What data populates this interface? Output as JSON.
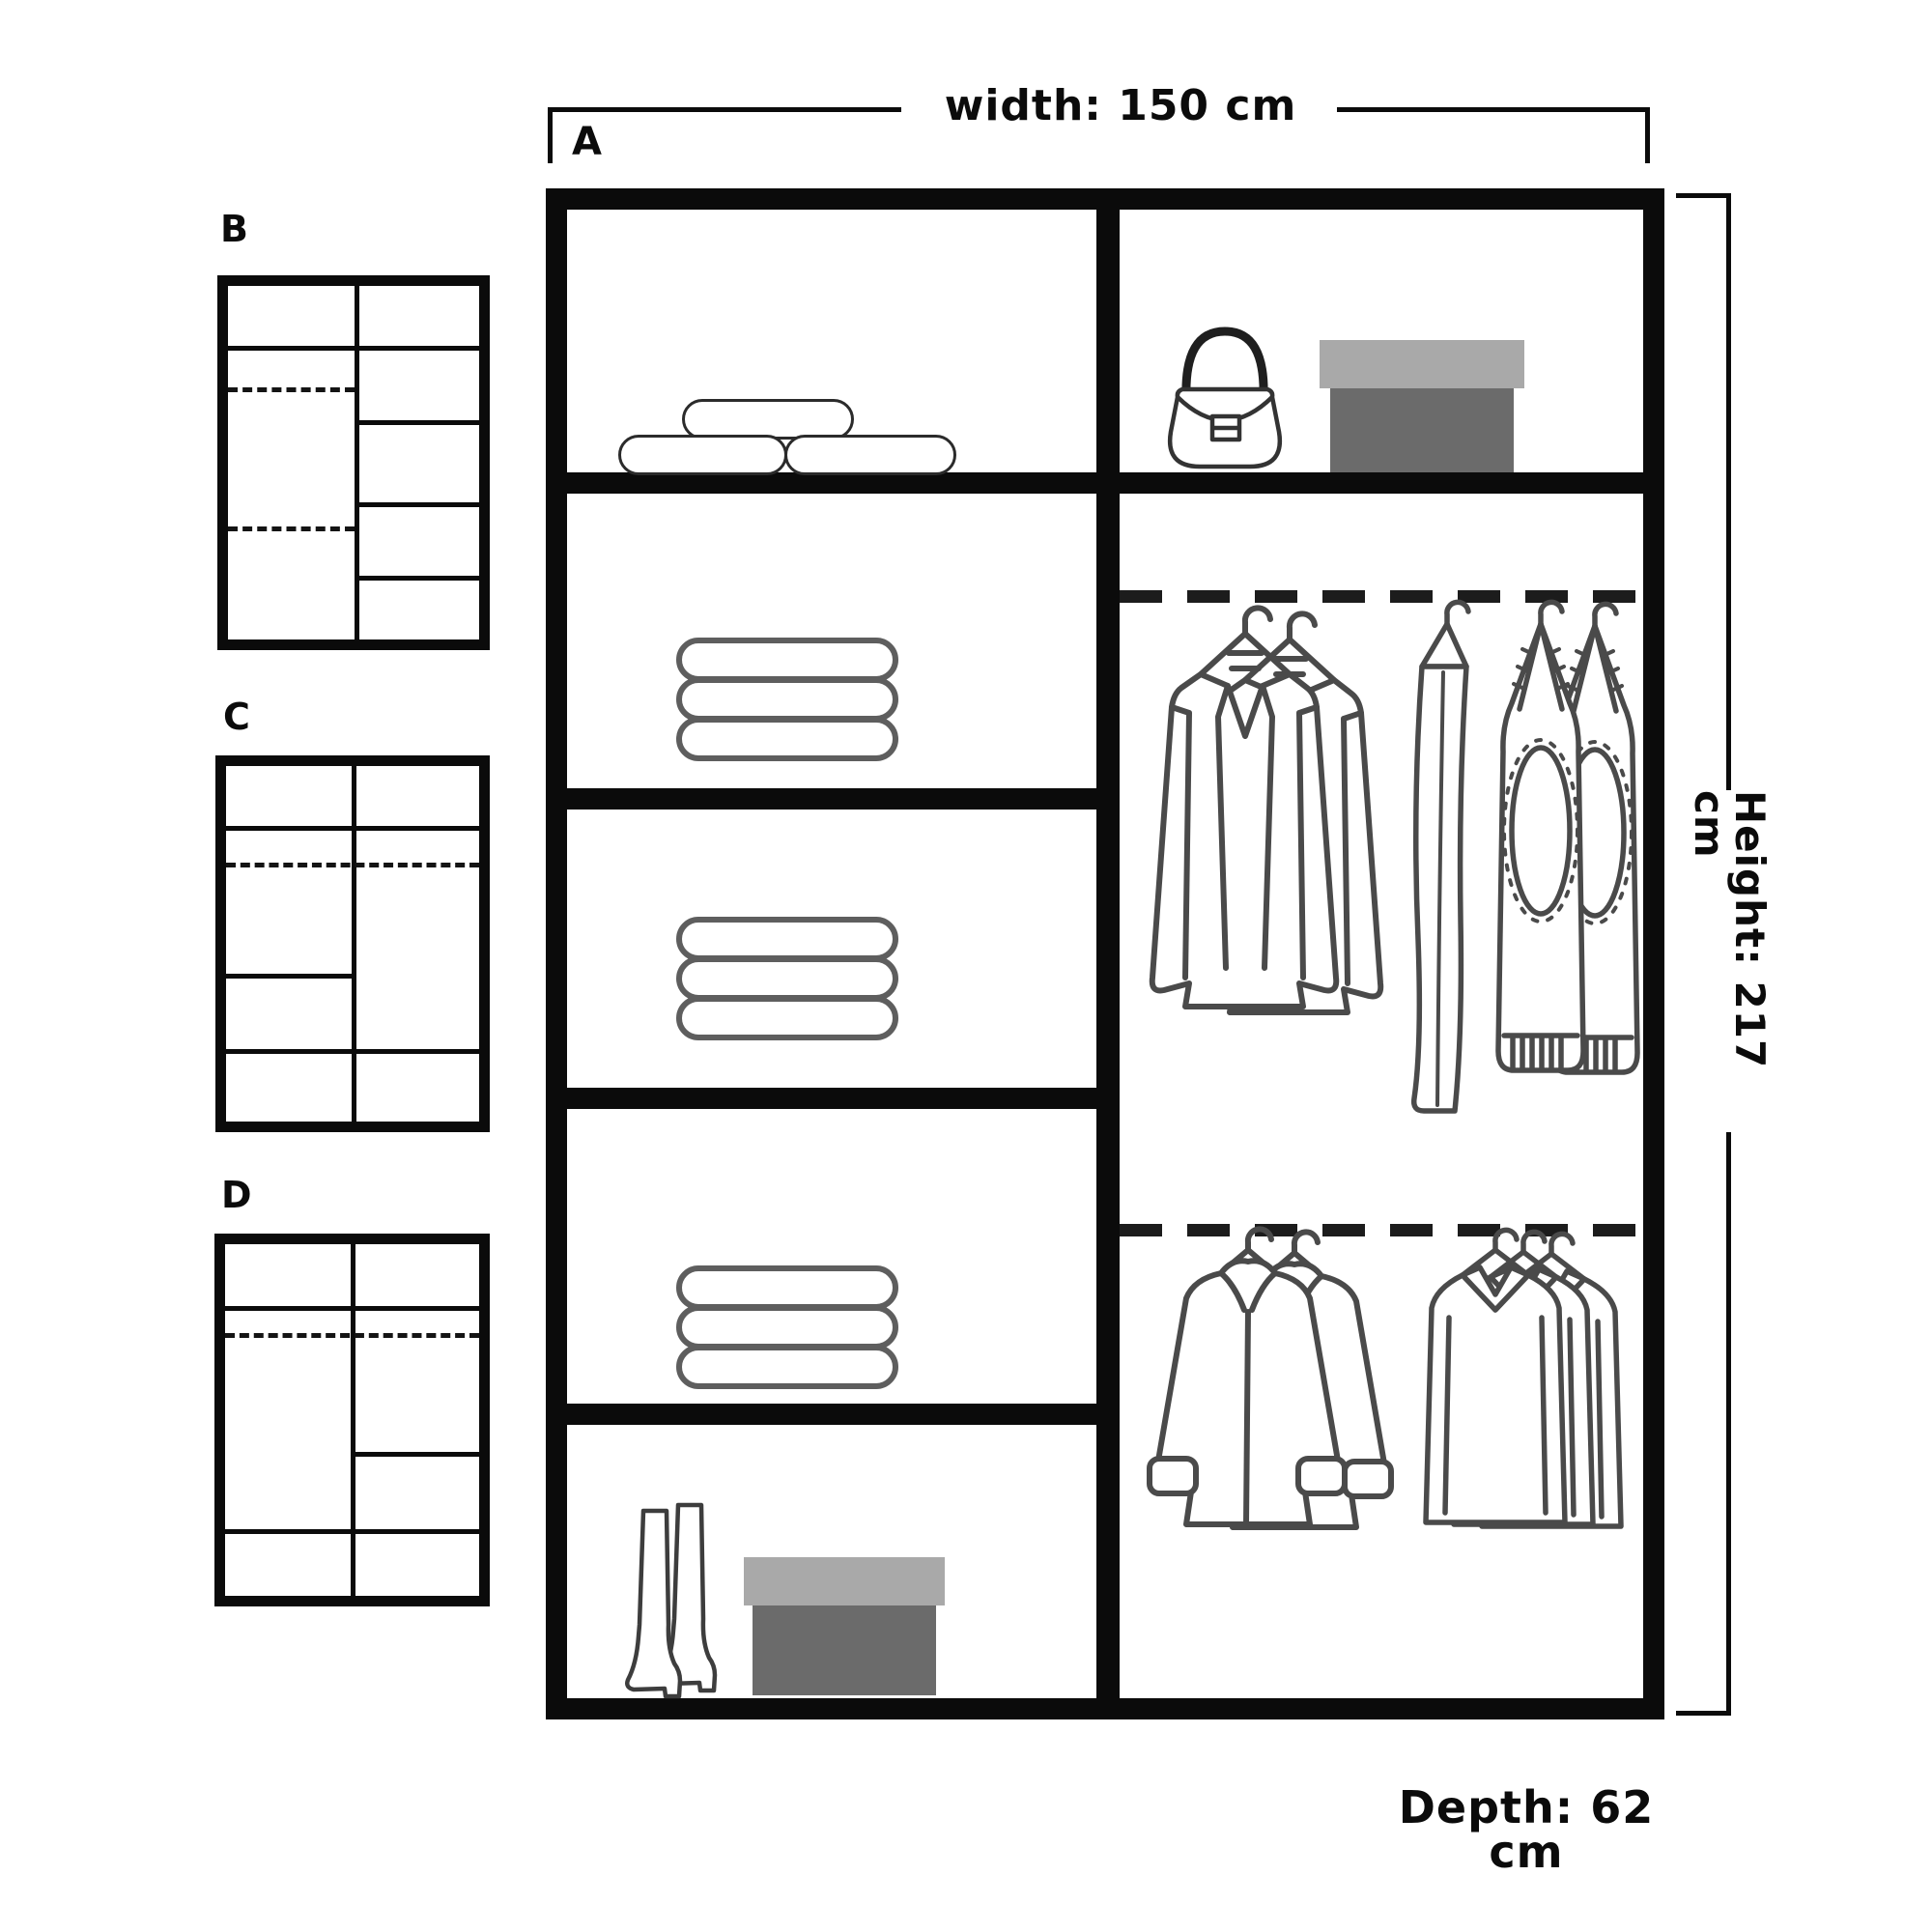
{
  "diagram": {
    "main_label": "A",
    "dimensions": {
      "width": "width: 150 cm",
      "height": "Height: 217 cm",
      "depth": "Depth: 62 cm"
    },
    "variants": [
      {
        "label": "B"
      },
      {
        "label": "C"
      },
      {
        "label": "D"
      }
    ],
    "main_wardrobe": {
      "left_column_sections": [
        "pillows",
        "towel-stack",
        "towel-stack",
        "towel-stack",
        "boots-and-shoebox"
      ],
      "right_column_sections": [
        "handbag-and-shoebox",
        "hanging-rail-jackets-and-trousers",
        "hanging-rail-coats-and-shirts"
      ]
    },
    "colors": {
      "frame": "#0b0b0b",
      "garment_outline": "#4a4a4a",
      "towel_outline": "#5e5e5e",
      "pillow_outline": "#2b2b2b",
      "shoebox_lid": "#a9a9a9",
      "shoebox_base": "#6b6b6b",
      "rail": "#1c1c1c"
    }
  }
}
